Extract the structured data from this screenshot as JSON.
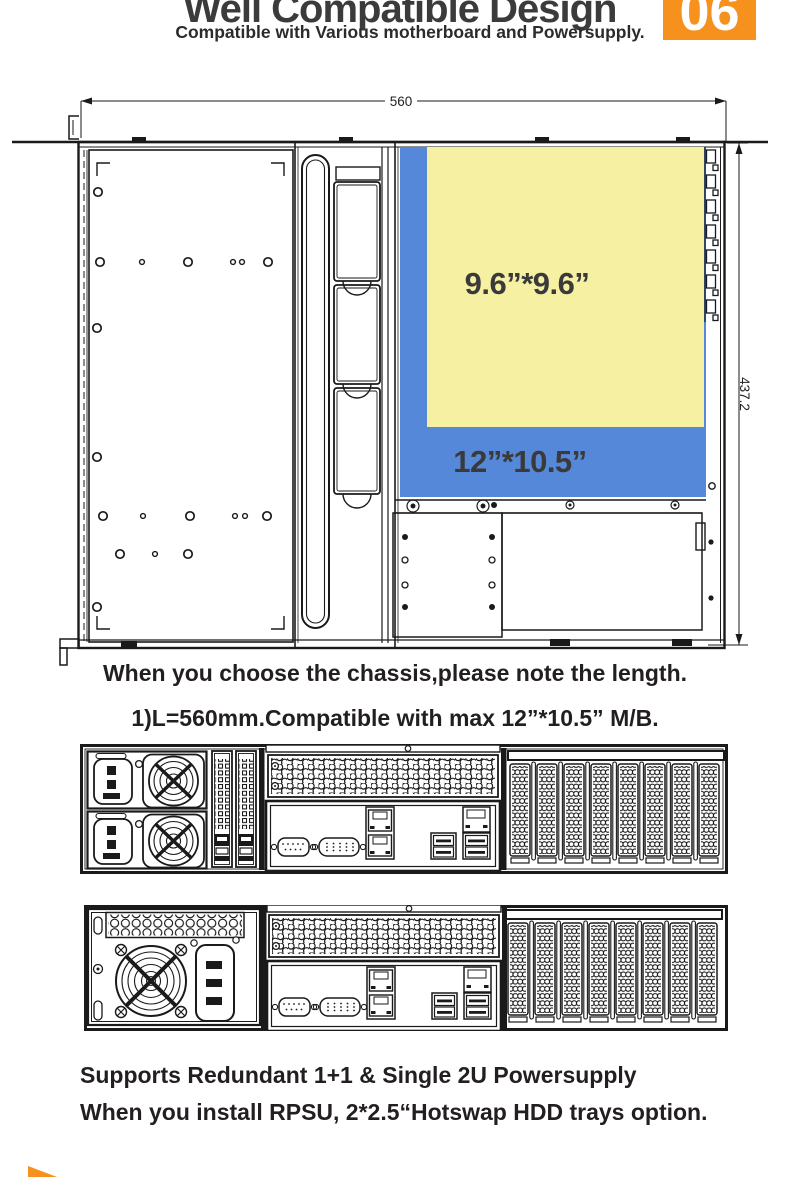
{
  "header": {
    "title": "Well Compatible Design",
    "badge_number": "06",
    "subtitle": "Compatible with Various motherboard and Powersupply."
  },
  "diagram": {
    "width_dim": "560",
    "depth_dim": "437.2",
    "mb_small_label": "9.6”*9.6”",
    "mb_large_label": "12”*10.5”"
  },
  "colors": {
    "accent_orange": "#F7911D",
    "mb_small_yellow": "#F6F0A2",
    "mb_large_blue": "#5588D8"
  },
  "captions": {
    "line1": "When you choose the chassis,please note the length.",
    "line2": "1)L=560mm.Compatible with max 12”*10.5” M/B.",
    "line3": "Supports Redundant 1+1 & Single 2U Powersupply",
    "line4": "When you install RPSU, 2*2.5“Hotswap HDD trays option."
  }
}
